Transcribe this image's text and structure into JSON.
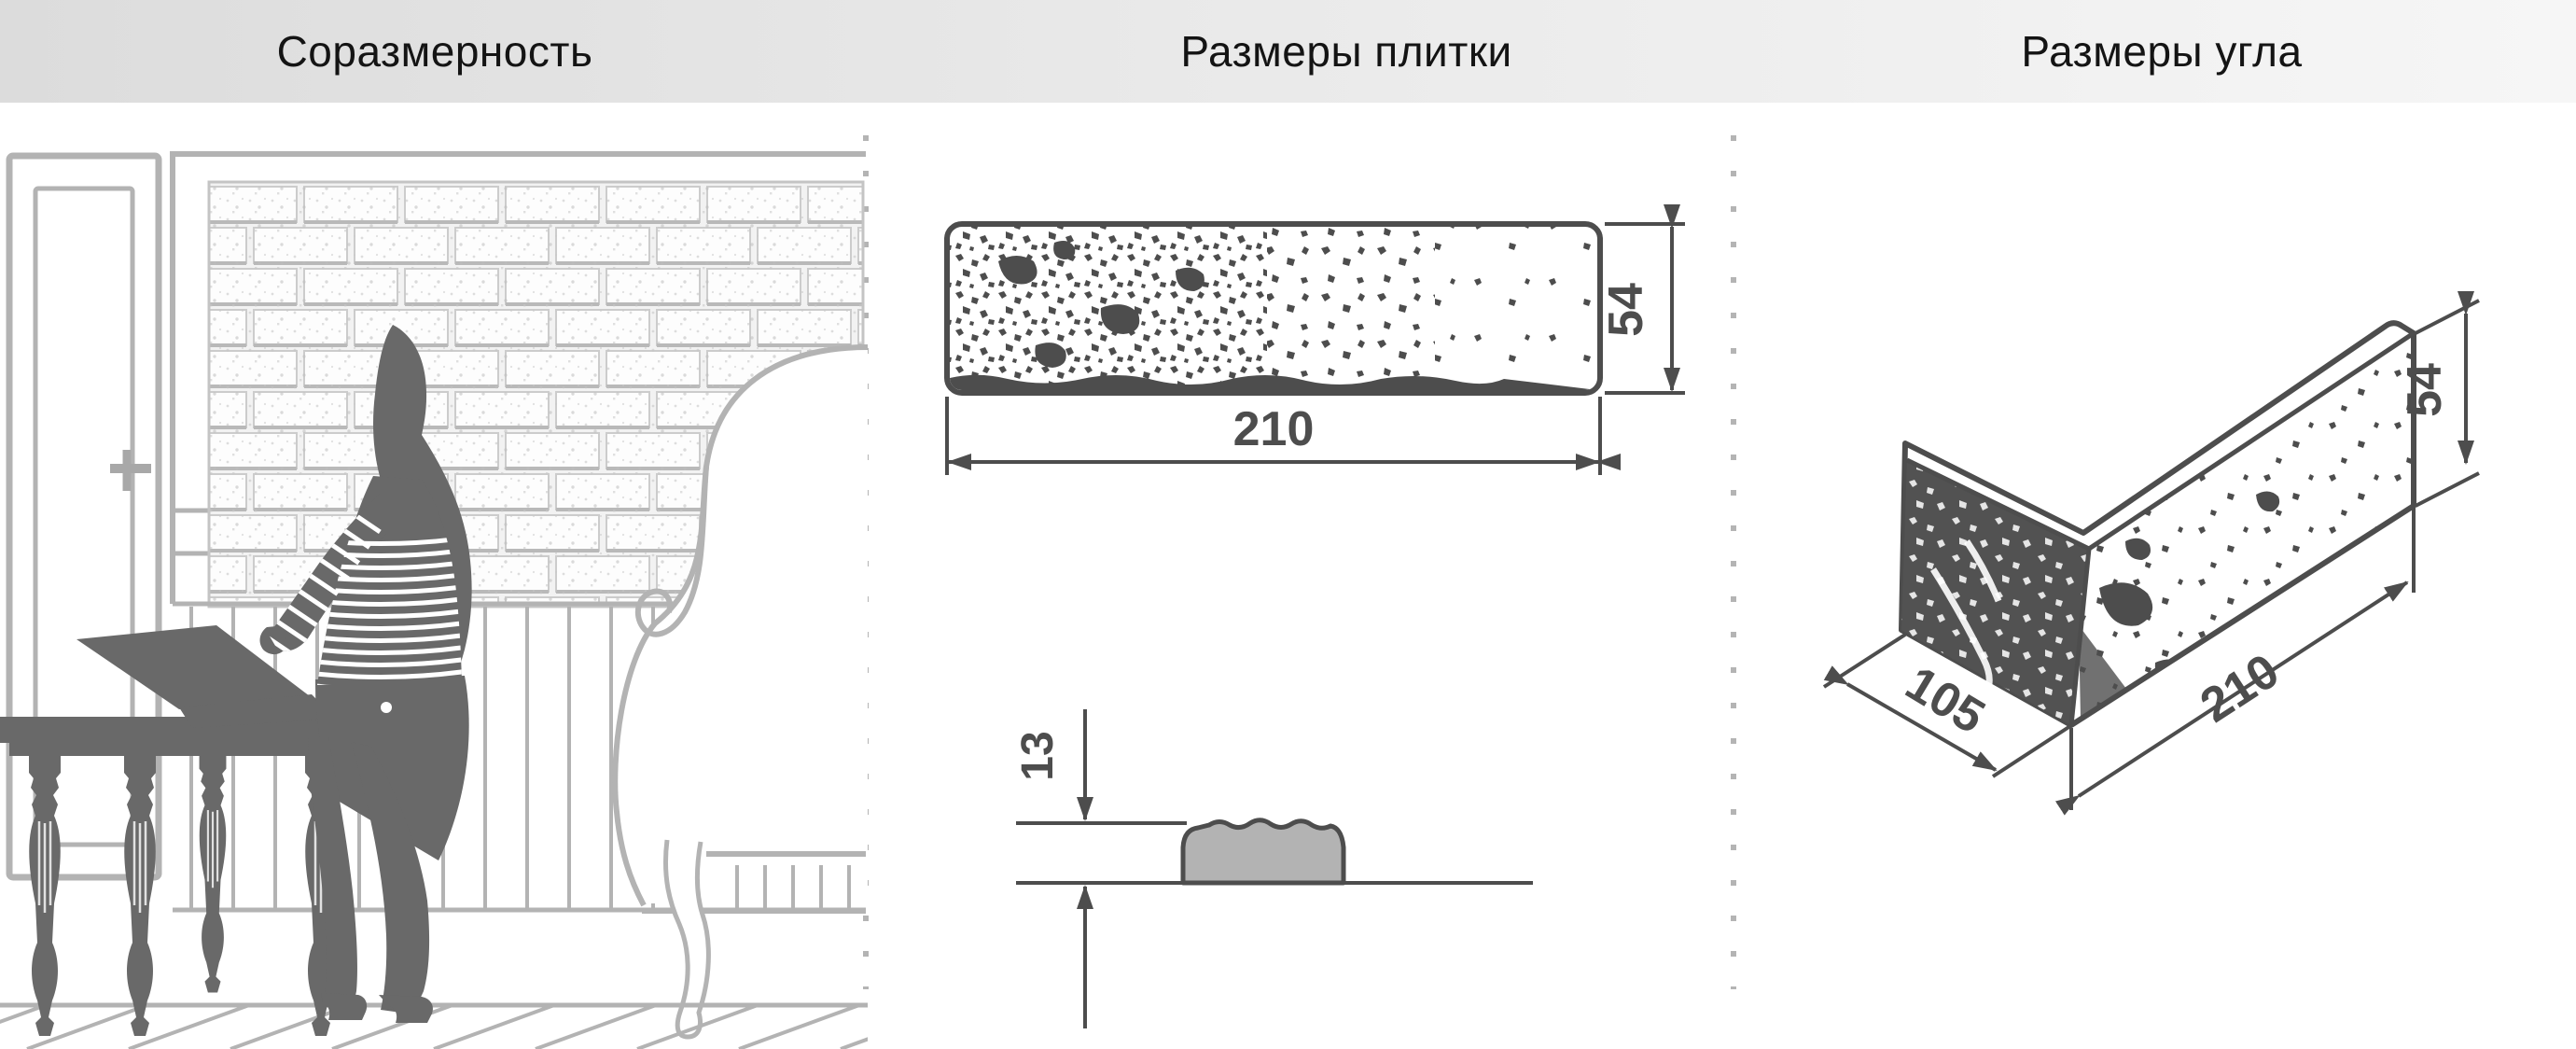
{
  "header": {
    "background_gradient": [
      "#dcdcdc",
      "#f6f6f6"
    ],
    "text_color": "#141414"
  },
  "sections": [
    {
      "id": "proportionality",
      "title": "Соразмерность"
    },
    {
      "id": "tile-dimensions",
      "title": "Размеры плитки"
    },
    {
      "id": "corner-dimensions",
      "title": "Размеры угла"
    }
  ],
  "tile": {
    "width": "210",
    "height": "54",
    "thickness": "13"
  },
  "corner": {
    "depth": "105",
    "length": "210",
    "height": "54"
  },
  "colors": {
    "dimension_lines": "#4d4d4d",
    "silhouette": "#696969",
    "light_outline": "#b3b3b3",
    "profile_fill": "#b3b3b3",
    "page_background": "#ffffff"
  }
}
